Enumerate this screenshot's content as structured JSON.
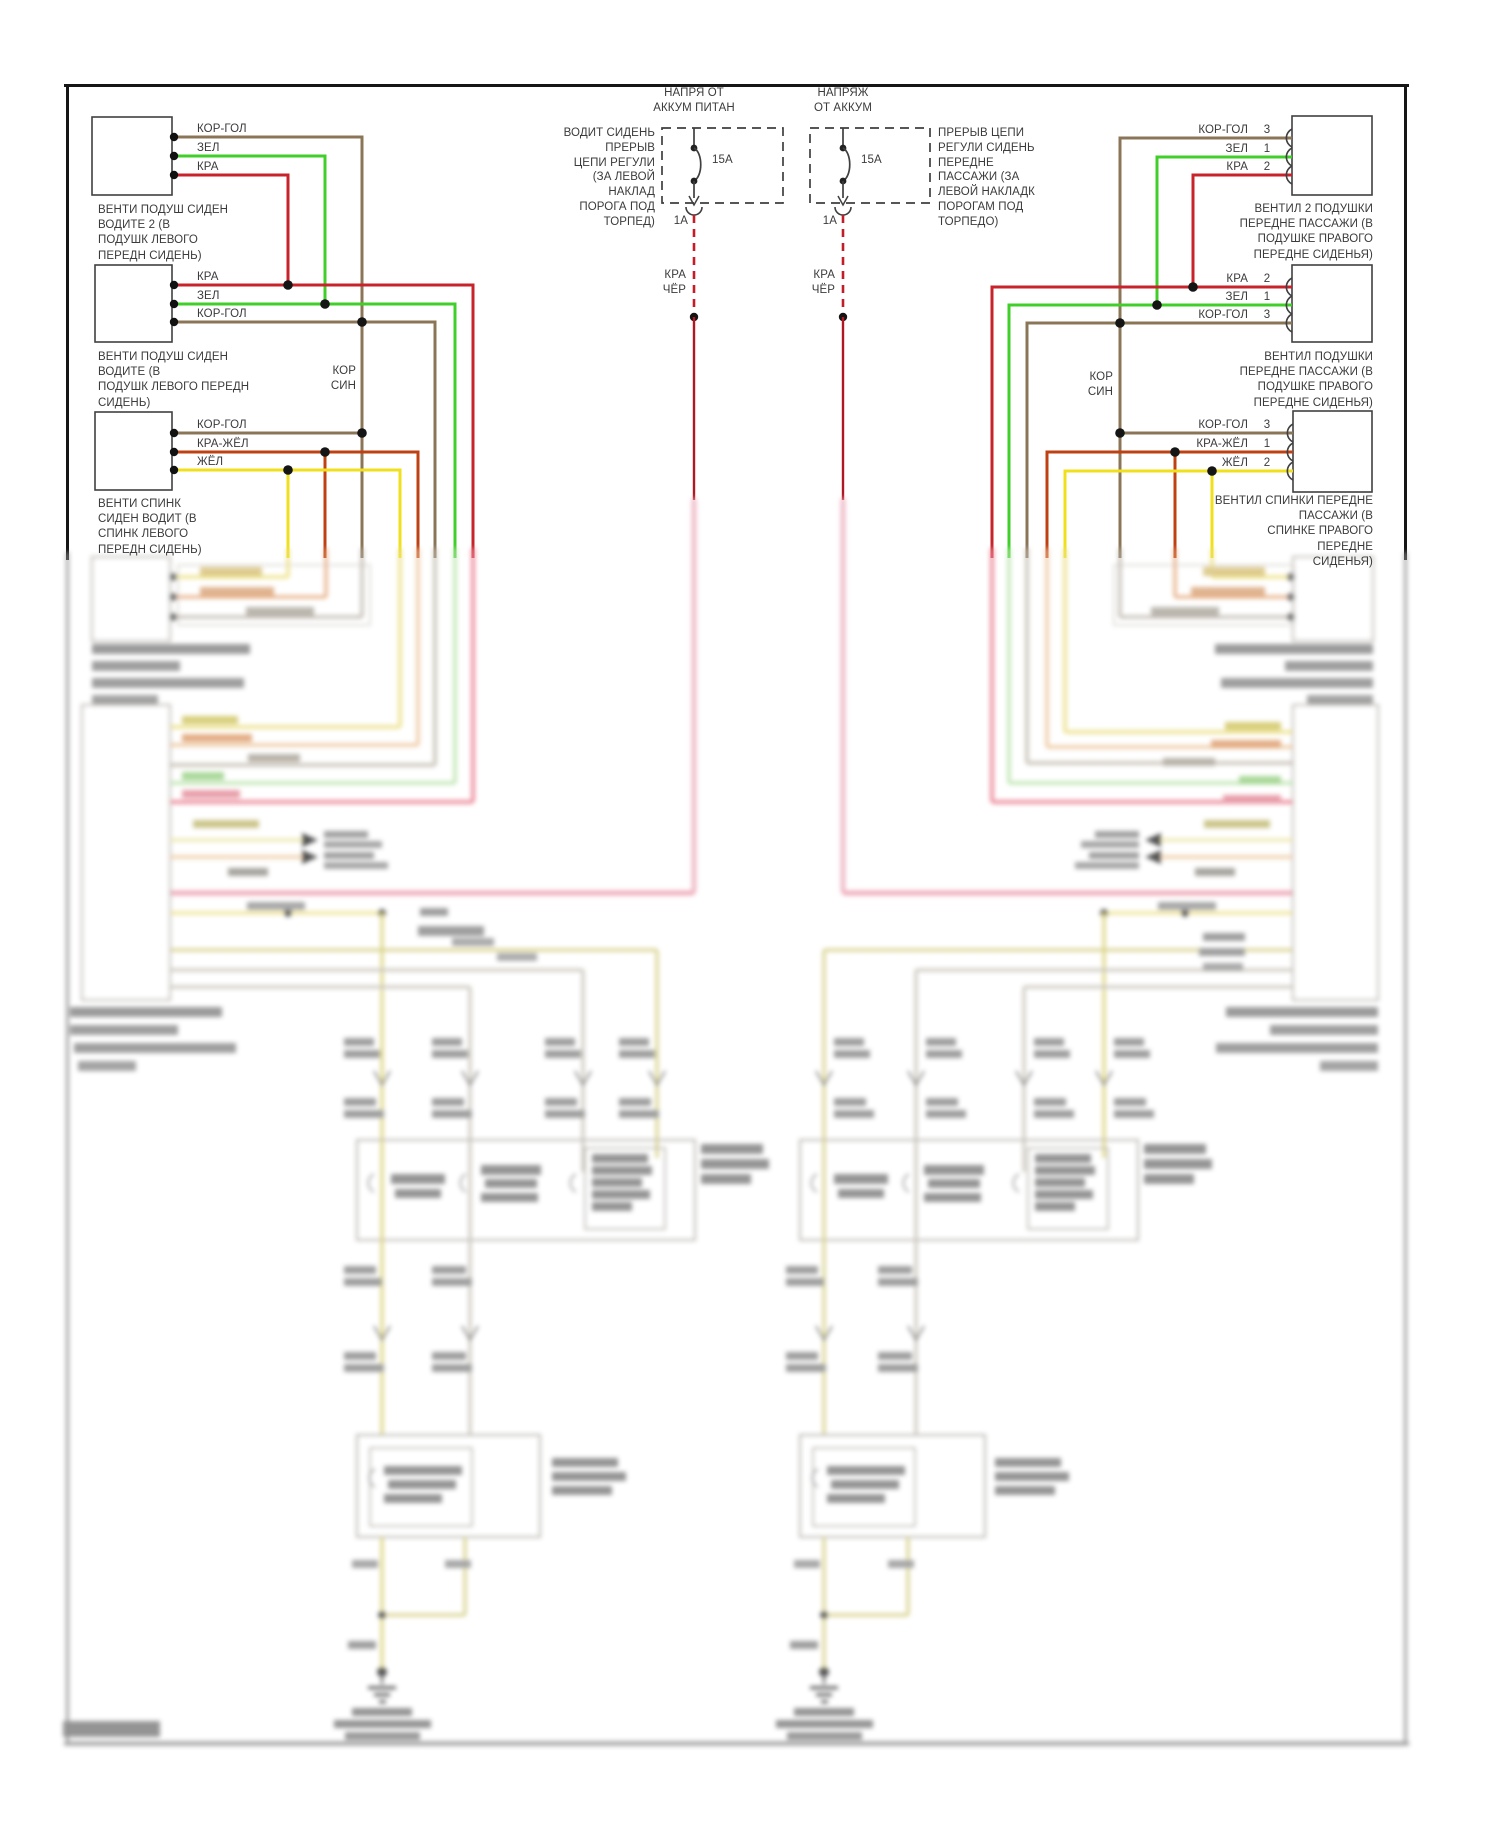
{
  "diagram": {
    "left_boxes": [
      {
        "wires": [
          "КОР-ГОЛ",
          "ЗЕЛ",
          "КРА"
        ],
        "caption": "ВЕНТИ ПОДУШ СИДЕН\nВОДИТЕ 2 (В\nПОДУШК ЛЕВОГО\nПЕРЕДН СИДЕНЬ)"
      },
      {
        "wires": [
          "КРА",
          "ЗЕЛ",
          "КОР-ГОЛ"
        ],
        "caption": "ВЕНТИ ПОДУШ СИДЕН\nВОДИТЕ (В\nПОДУШК ЛЕВОГО ПЕРЕДН\nСИДЕНЬ)"
      },
      {
        "wires": [
          "КОР-ГОЛ",
          "КРА-ЖЁЛ",
          "ЖЁЛ"
        ],
        "caption": "ВЕНТИ СПИНК\nСИДЕН ВОДИТ (В\nСПИНК ЛЕВОГО\nПЕРЕДН СИДЕНЬ)"
      }
    ],
    "right_boxes": [
      {
        "wires": [
          {
            "label": "КОР-ГОЛ",
            "pin": "3"
          },
          {
            "label": "ЗЕЛ",
            "pin": "1"
          },
          {
            "label": "КРА",
            "pin": "2"
          }
        ],
        "caption": "ВЕНТИЛ 2 ПОДУШКИ\nПЕРЕДНЕ ПАССАЖИ (В\nПОДУШКЕ ПРАВОГО\nПЕРЕДНЕ СИДЕНЬЯ)"
      },
      {
        "wires": [
          {
            "label": "КРА",
            "pin": "2"
          },
          {
            "label": "ЗЕЛ",
            "pin": "1"
          },
          {
            "label": "КОР-ГОЛ",
            "pin": "3"
          }
        ],
        "caption": "ВЕНТИЛ ПОДУШКИ\nПЕРЕДНЕ ПАССАЖИ (В\nПОДУШКЕ ПРАВОГО\nПЕРЕДНЕ СИДЕНЬЯ)"
      },
      {
        "wires": [
          {
            "label": "КОР-ГОЛ",
            "pin": "3"
          },
          {
            "label": "КРА-ЖЁЛ",
            "pin": "1"
          },
          {
            "label": "ЖЁЛ",
            "pin": "2"
          }
        ],
        "caption": "ВЕНТИЛ СПИНКИ ПЕРЕДНЕ\nПАССАЖИ (В\nСПИНКЕ ПРАВОГО ПЕРЕДНЕ\nСИДЕНЬЯ)"
      }
    ],
    "fuses": [
      {
        "title": "НАПРЯ ОТ\nАККУМ ПИТАН",
        "side_text": "ВОДИТ СИДЕНЬ\nПРЕРЫВ\nЦЕПИ РЕГУЛИ\n(ЗА ЛЕВОЙ\nНАКЛАД\nПОРОГА ПОД\nТОРПЕД)",
        "fuse_rating": "15А",
        "branch_rating": "1А",
        "wire_label": "КРА\nЧЁР"
      },
      {
        "title": "НАПРЯЖ\nОТ АККУМ",
        "side_text": "ПРЕРЫВ ЦЕПИ\nРЕГУЛИ СИДЕНЬ\nПЕРЕДНЕ\nПАССАЖИ (ЗА\nЛЕВОЙ НАКЛАДК\nПОРОГАМ ПОД\nТОРПЕДО)",
        "fuse_rating": "15А",
        "branch_rating": "1А",
        "wire_label": "КРА\nЧЁР"
      }
    ],
    "splice_left": "КОР\nСИН",
    "splice_right": "КОР\nСИН",
    "colors": {
      "brown": "#8b7557",
      "green": "#3fcf28",
      "red": "#c8232b",
      "yellow": "#f0e01c",
      "red_yellow": "#bf4012",
      "dashed_red": "#c41d2a"
    }
  }
}
